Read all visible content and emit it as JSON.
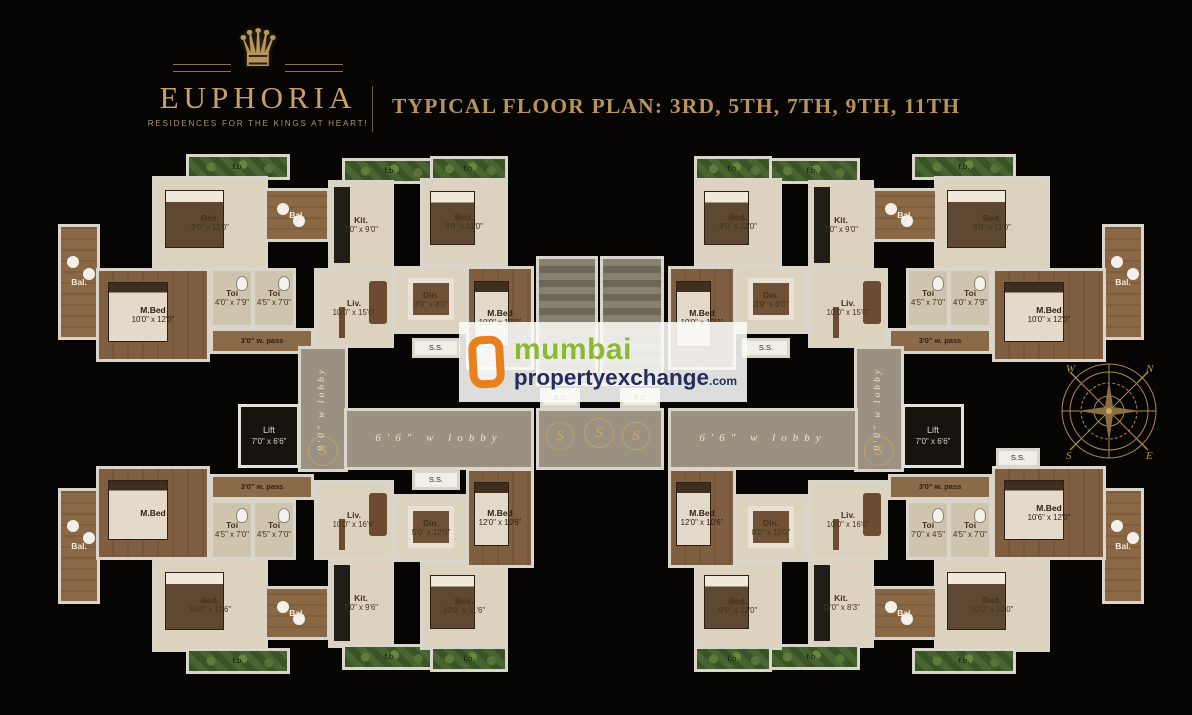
{
  "header": {
    "brand": "EUPHORIA",
    "tagline": "RESIDENCES FOR THE KINGS AT HEART!",
    "title": "TYPICAL FLOOR PLAN: 3RD, 5TH, 7TH, 9TH, 11TH",
    "crown_glyph": "♛",
    "gold": "#c7a166"
  },
  "watermark": {
    "line1": "mumbai",
    "line2": "propertyexchange",
    "line2_suffix": ".com",
    "colors": {
      "icon_orange": "#e8811d",
      "green": "#8cb832",
      "navy": "#232e5f"
    }
  },
  "compass": {
    "n": "N",
    "e": "E",
    "s": "S",
    "w": "W"
  },
  "plan": {
    "rooms": [
      {
        "k": "green",
        "n": "f.b.",
        "x": 188,
        "y": 156,
        "w": 100,
        "h": 22
      },
      {
        "k": "cream",
        "n": "Bed.",
        "d": "9'0\" x 11'0\"",
        "x": 154,
        "y": 178,
        "w": 112,
        "h": 90
      },
      {
        "k": "balc",
        "n": "Bal.",
        "x": 60,
        "y": 226,
        "w": 38,
        "h": 112
      },
      {
        "k": "wood",
        "n": "M.Bed",
        "d": "10'0\" x 12'0\"",
        "x": 98,
        "y": 270,
        "w": 110,
        "h": 90
      },
      {
        "k": "cream2",
        "n": "Toi",
        "d": "4'0\" x 7'9\"",
        "x": 212,
        "y": 270,
        "w": 40,
        "h": 56
      },
      {
        "k": "cream2",
        "n": "Toi",
        "d": "4'5\" x 7'0\"",
        "x": 254,
        "y": 270,
        "w": 40,
        "h": 56
      },
      {
        "k": "pass",
        "n": "3'0\" w. pass",
        "x": 212,
        "y": 330,
        "w": 100,
        "h": 22
      },
      {
        "k": "green",
        "n": "f.b.",
        "x": 344,
        "y": 160,
        "w": 92,
        "h": 22
      },
      {
        "k": "cream",
        "n": "Kit.",
        "d": "7'0\" x 9'0\"",
        "x": 330,
        "y": 182,
        "w": 62,
        "h": 86
      },
      {
        "k": "balc",
        "n": "Bal.",
        "x": 266,
        "y": 190,
        "w": 62,
        "h": 50
      },
      {
        "k": "cream",
        "n": "Liv.",
        "d": "10'0\" x 15'0\"",
        "x": 316,
        "y": 270,
        "w": 76,
        "h": 76
      },
      {
        "k": "green",
        "n": "f.b.",
        "x": 432,
        "y": 158,
        "w": 74,
        "h": 22
      },
      {
        "k": "cream",
        "n": "Bed.",
        "d": "9'0\" x 11'0\"",
        "x": 422,
        "y": 180,
        "w": 84,
        "h": 84
      },
      {
        "k": "cream",
        "n": "Din.",
        "d": "3'9\" x 8'0\"",
        "x": 396,
        "y": 268,
        "w": 70,
        "h": 64
      },
      {
        "k": "wood",
        "n": "M.Bed",
        "d": "10'0\" x 12'0\"",
        "x": 468,
        "y": 268,
        "w": 64,
        "h": 100
      },
      {
        "k": "duct",
        "n": "S.S.",
        "x": 414,
        "y": 340,
        "w": 44,
        "h": 16
      },
      {
        "k": "green",
        "n": "f.b.",
        "x": 914,
        "y": 156,
        "w": 100,
        "h": 22
      },
      {
        "k": "cream",
        "n": "Bed.",
        "d": "9'0\" x 11'0\"",
        "x": 936,
        "y": 178,
        "w": 112,
        "h": 90
      },
      {
        "k": "balc",
        "n": "Bal.",
        "x": 1104,
        "y": 226,
        "w": 38,
        "h": 112
      },
      {
        "k": "wood",
        "n": "M.Bed",
        "d": "10'0\" x 12'0\"",
        "x": 994,
        "y": 270,
        "w": 110,
        "h": 90
      },
      {
        "k": "cream2",
        "n": "Toi",
        "d": "4'0\" x 7'9\"",
        "x": 950,
        "y": 270,
        "w": 40,
        "h": 56
      },
      {
        "k": "cream2",
        "n": "Toi",
        "d": "4'5\" x 7'0\"",
        "x": 908,
        "y": 270,
        "w": 40,
        "h": 56
      },
      {
        "k": "pass",
        "n": "3'0\" w. pass",
        "x": 890,
        "y": 330,
        "w": 100,
        "h": 22
      },
      {
        "k": "green",
        "n": "f.b.",
        "x": 766,
        "y": 160,
        "w": 92,
        "h": 22
      },
      {
        "k": "cream",
        "n": "Kit.",
        "d": "7'0\" x 9'0\"",
        "x": 810,
        "y": 182,
        "w": 62,
        "h": 86
      },
      {
        "k": "balc",
        "n": "Bal.",
        "x": 874,
        "y": 190,
        "w": 62,
        "h": 50
      },
      {
        "k": "cream",
        "n": "Liv.",
        "d": "10'0\" x 15'0\"",
        "x": 810,
        "y": 270,
        "w": 76,
        "h": 76
      },
      {
        "k": "green",
        "n": "f.b.",
        "x": 696,
        "y": 158,
        "w": 74,
        "h": 22
      },
      {
        "k": "cream",
        "n": "Bed.",
        "d": "9'0\" x 11'0\"",
        "x": 696,
        "y": 180,
        "w": 84,
        "h": 84
      },
      {
        "k": "cream",
        "n": "Din.",
        "d": "3'9\" x 8'0\"",
        "x": 736,
        "y": 268,
        "w": 70,
        "h": 64
      },
      {
        "k": "wood",
        "n": "M.Bed",
        "d": "10'0\" x 12'0\"",
        "x": 670,
        "y": 268,
        "w": 64,
        "h": 100
      },
      {
        "k": "duct",
        "n": "S.S.",
        "x": 744,
        "y": 340,
        "w": 44,
        "h": 16
      },
      {
        "k": "lift",
        "n": "Lift",
        "d": "7'0\" x 6'6\"",
        "x": 240,
        "y": 406,
        "w": 58,
        "h": 60
      },
      {
        "k": "corridor-v",
        "n": "9'0\" w lobby",
        "x": 300,
        "y": 348,
        "w": 46,
        "h": 122
      },
      {
        "k": "corridor-h",
        "n": "6'6\" w lobby",
        "x": 346,
        "y": 410,
        "w": 186,
        "h": 58
      },
      {
        "k": "stair",
        "x": 538,
        "y": 258,
        "w": 58,
        "h": 126
      },
      {
        "k": "stair",
        "x": 602,
        "y": 258,
        "w": 60,
        "h": 126
      },
      {
        "k": "duct",
        "n": "E.D",
        "x": 542,
        "y": 390,
        "w": 36,
        "h": 16
      },
      {
        "k": "duct",
        "n": "F.D",
        "x": 622,
        "y": 390,
        "w": 36,
        "h": 16
      },
      {
        "k": "lobby",
        "x": 538,
        "y": 410,
        "w": 124,
        "h": 58
      },
      {
        "k": "swirl",
        "n": "S",
        "x": 546,
        "y": 422,
        "w": 28,
        "h": 28
      },
      {
        "k": "swirl",
        "n": "S",
        "x": 584,
        "y": 418,
        "w": 30,
        "h": 30
      },
      {
        "k": "swirl",
        "n": "S",
        "x": 622,
        "y": 422,
        "w": 28,
        "h": 28
      },
      {
        "k": "corridor-v",
        "n": "9'0\" w lobby",
        "x": 856,
        "y": 348,
        "w": 46,
        "h": 122
      },
      {
        "k": "corridor-h",
        "n": "6'6\" w lobby",
        "x": 670,
        "y": 410,
        "w": 186,
        "h": 58
      },
      {
        "k": "lift",
        "n": "Lift",
        "d": "7'0\" x 6'6\"",
        "x": 904,
        "y": 406,
        "w": 58,
        "h": 60
      },
      {
        "k": "swirl",
        "n": "S",
        "x": 308,
        "y": 436,
        "w": 30,
        "h": 30
      },
      {
        "k": "swirl",
        "n": "S",
        "x": 864,
        "y": 436,
        "w": 30,
        "h": 30
      },
      {
        "k": "balc",
        "n": "Bal.",
        "x": 60,
        "y": 490,
        "w": 38,
        "h": 112
      },
      {
        "k": "wood",
        "n": "M.Bed",
        "x": 98,
        "y": 468,
        "w": 110,
        "h": 90
      },
      {
        "k": "cream",
        "n": "Bed.",
        "d": "10'0\" x 11'6\"",
        "x": 154,
        "y": 560,
        "w": 112,
        "h": 90
      },
      {
        "k": "green",
        "n": "f.b.",
        "x": 188,
        "y": 650,
        "w": 100,
        "h": 22
      },
      {
        "k": "cream2",
        "n": "Toi",
        "d": "4'5\" x 7'0\"",
        "x": 212,
        "y": 502,
        "w": 40,
        "h": 56
      },
      {
        "k": "cream2",
        "n": "Toi",
        "d": "4'5\" x 7'0\"",
        "x": 254,
        "y": 502,
        "w": 40,
        "h": 56
      },
      {
        "k": "pass",
        "n": "3'0\" w. pass",
        "x": 212,
        "y": 476,
        "w": 100,
        "h": 22
      },
      {
        "k": "cream",
        "n": "Liv.",
        "d": "10'0\" x 16'9\"",
        "x": 316,
        "y": 482,
        "w": 76,
        "h": 76
      },
      {
        "k": "cream",
        "n": "Kit.",
        "d": "7'0\" x 9'6\"",
        "x": 330,
        "y": 560,
        "w": 62,
        "h": 86
      },
      {
        "k": "balc",
        "n": "Bal.",
        "x": 266,
        "y": 588,
        "w": 62,
        "h": 50
      },
      {
        "k": "green",
        "n": "f.b.",
        "x": 344,
        "y": 646,
        "w": 92,
        "h": 22
      },
      {
        "k": "cream",
        "n": "Din.",
        "d": "5'0\" x 12'0\"",
        "x": 396,
        "y": 496,
        "w": 70,
        "h": 64
      },
      {
        "k": "cream",
        "n": "Bed.",
        "d": "10'0\" x 11'6\"",
        "x": 422,
        "y": 564,
        "w": 84,
        "h": 84
      },
      {
        "k": "green",
        "n": "f.b.",
        "x": 432,
        "y": 648,
        "w": 74,
        "h": 22
      },
      {
        "k": "wood",
        "n": "M.Bed",
        "d": "12'0\" x 10'6\"",
        "x": 468,
        "y": 470,
        "w": 64,
        "h": 96
      },
      {
        "k": "duct",
        "n": "S.S.",
        "x": 414,
        "y": 472,
        "w": 44,
        "h": 16
      },
      {
        "k": "balc",
        "n": "Bal.",
        "x": 1104,
        "y": 490,
        "w": 38,
        "h": 112
      },
      {
        "k": "wood",
        "n": "M.Bed",
        "d": "10'6\" x 12'0\"",
        "x": 994,
        "y": 468,
        "w": 110,
        "h": 90
      },
      {
        "k": "cream",
        "n": "Bed.",
        "d": "10'0\" x 12'0\"",
        "x": 936,
        "y": 560,
        "w": 112,
        "h": 90
      },
      {
        "k": "green",
        "n": "f.b.",
        "x": 914,
        "y": 650,
        "w": 100,
        "h": 22
      },
      {
        "k": "cream2",
        "n": "Toi",
        "d": "4'5\" x 7'0\"",
        "x": 950,
        "y": 502,
        "w": 40,
        "h": 56
      },
      {
        "k": "cream2",
        "n": "Toi",
        "d": "7'0\" x 4'5\"",
        "x": 908,
        "y": 502,
        "w": 40,
        "h": 56
      },
      {
        "k": "pass",
        "n": "3'0\" w. pass",
        "x": 890,
        "y": 476,
        "w": 100,
        "h": 22
      },
      {
        "k": "cream",
        "n": "Liv.",
        "d": "10'0\" x 16'0\"",
        "x": 810,
        "y": 482,
        "w": 76,
        "h": 76
      },
      {
        "k": "cream",
        "n": "Kit.",
        "d": "11'0\" x 8'3\"",
        "x": 810,
        "y": 560,
        "w": 62,
        "h": 86
      },
      {
        "k": "balc",
        "n": "Bal.",
        "x": 874,
        "y": 588,
        "w": 62,
        "h": 50
      },
      {
        "k": "green",
        "n": "f.b.",
        "x": 766,
        "y": 646,
        "w": 92,
        "h": 22
      },
      {
        "k": "cream",
        "n": "Din.",
        "d": "8'0\" x 10'0\"",
        "x": 736,
        "y": 496,
        "w": 70,
        "h": 64
      },
      {
        "k": "cream",
        "n": "Bed.",
        "d": "9'0\" x 12'0\"",
        "x": 696,
        "y": 564,
        "w": 84,
        "h": 84
      },
      {
        "k": "green",
        "n": "f.b.",
        "x": 696,
        "y": 648,
        "w": 74,
        "h": 22
      },
      {
        "k": "wood",
        "n": "M.Bed",
        "d": "12'0\" x 10'6\"",
        "x": 670,
        "y": 470,
        "w": 64,
        "h": 96
      },
      {
        "k": "duct",
        "n": "S.S.",
        "x": 998,
        "y": 450,
        "w": 40,
        "h": 16
      }
    ]
  }
}
